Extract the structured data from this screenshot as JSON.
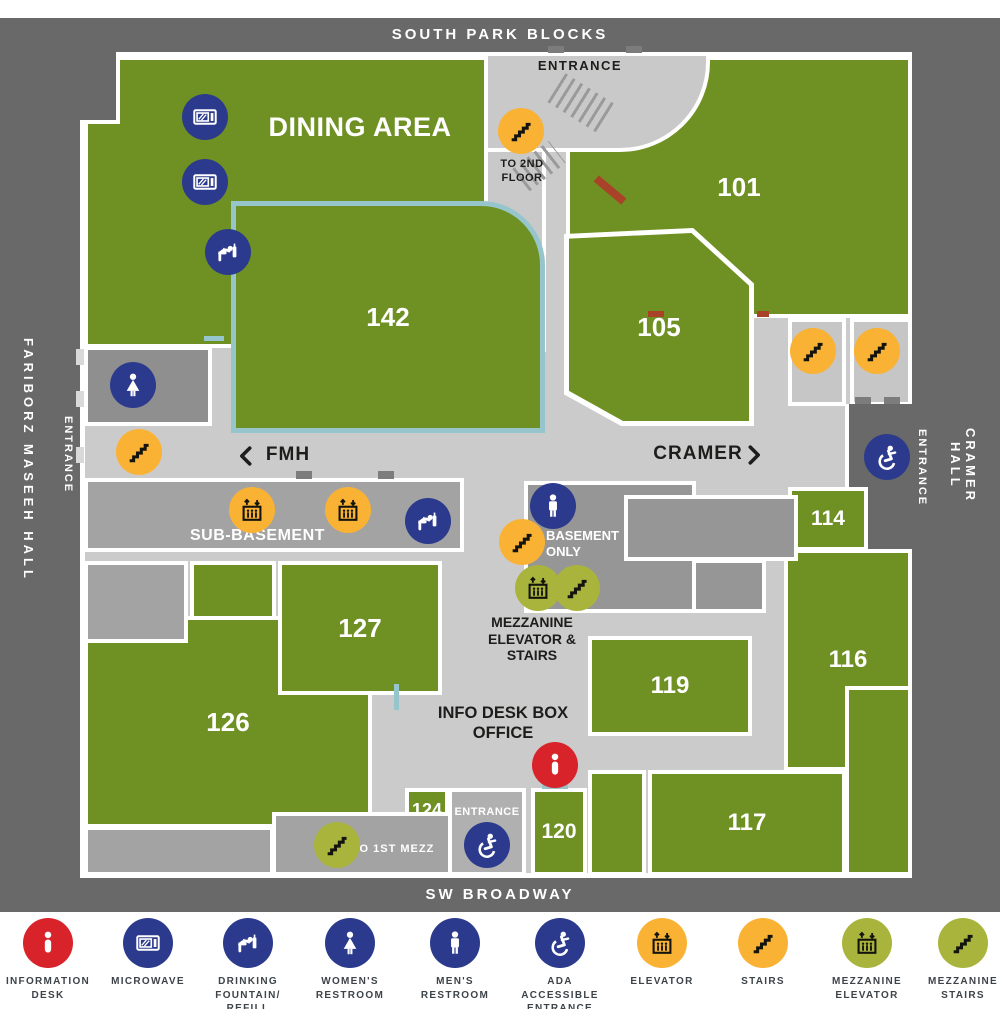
{
  "streets": {
    "top": "SOUTH PARK BLOCKS",
    "bottom": "SW BROADWAY",
    "left_hall": "FARIBORZ MASEEH HALL",
    "right_hall": "CRAMER HALL"
  },
  "map": {
    "dining": "DINING AREA",
    "rooms": {
      "r101": "101",
      "r142": "142",
      "r105": "105",
      "r114": "114",
      "r116": "116",
      "r119": "119",
      "r117": "117",
      "r120": "120",
      "r124": "124",
      "r126": "126",
      "r127": "127"
    },
    "labels": {
      "entrance_top": "ENTRANCE",
      "to_2nd_floor": "TO 2ND FLOOR",
      "fmh": "FMH",
      "cramer": "CRAMER",
      "sub_basement": "SUB-BASEMENT",
      "basement_only": "BASEMENT ONLY",
      "mezzanine": "MEZZANINE ELEVATOR & STAIRS",
      "info_desk": "INFO DESK BOX OFFICE",
      "entrance_left": "ENTRANCE",
      "entrance_right": "ENTRANCE",
      "entrance_bottom": "ENTRANCE",
      "to_1st_mezz": "TO 1ST MEZZ"
    }
  },
  "legend": {
    "items": [
      {
        "id": "information-desk",
        "glyph": "info",
        "color": "#d8232a",
        "ink": "#ffffff",
        "label": "INFORMATION DESK"
      },
      {
        "id": "microwave",
        "glyph": "microwave",
        "color": "#2b3a8c",
        "ink": "#ffffff",
        "label": "MICROWAVE"
      },
      {
        "id": "drinking-fountain-refill-station",
        "glyph": "fountain",
        "color": "#2b3a8c",
        "ink": "#ffffff",
        "label": "DRINKING FOUNTAIN/ REFILL STATION"
      },
      {
        "id": "womens-restroom",
        "glyph": "woman",
        "color": "#2b3a8c",
        "ink": "#ffffff",
        "label": "WOMEN'S RESTROOM"
      },
      {
        "id": "mens-restroom",
        "glyph": "man",
        "color": "#2b3a8c",
        "ink": "#ffffff",
        "label": "MEN'S RESTROOM"
      },
      {
        "id": "ada-accessible-entrance",
        "glyph": "ada",
        "color": "#2b3a8c",
        "ink": "#ffffff",
        "label": "ADA ACCESSIBLE ENTRANCE"
      },
      {
        "id": "elevator",
        "glyph": "elevator",
        "color": "#f9b234",
        "ink": "#14140f",
        "label": "ELEVATOR"
      },
      {
        "id": "stairs",
        "glyph": "stairs",
        "color": "#f9b234",
        "ink": "#14140f",
        "label": "STAIRS"
      },
      {
        "id": "mezzanine-elevator",
        "glyph": "elevator",
        "color": "#a9b43c",
        "ink": "#14140f",
        "label": "MEZZANINE ELEVATOR"
      },
      {
        "id": "mezzanine-stairs",
        "glyph": "stairs",
        "color": "#a9b43c",
        "ink": "#14140f",
        "label": "MEZZANINE STAIRS"
      }
    ]
  },
  "colors": {
    "exterior": "#696969",
    "corridor": "#cccbcb",
    "room_green": "#6f9023",
    "accent_teal": "#96c5cb",
    "accent_brick": "#a8432a",
    "icon_blue": "#2b3a8c",
    "icon_yellow": "#f9b234",
    "icon_olive": "#a9b43c",
    "icon_red": "#d8232a"
  }
}
